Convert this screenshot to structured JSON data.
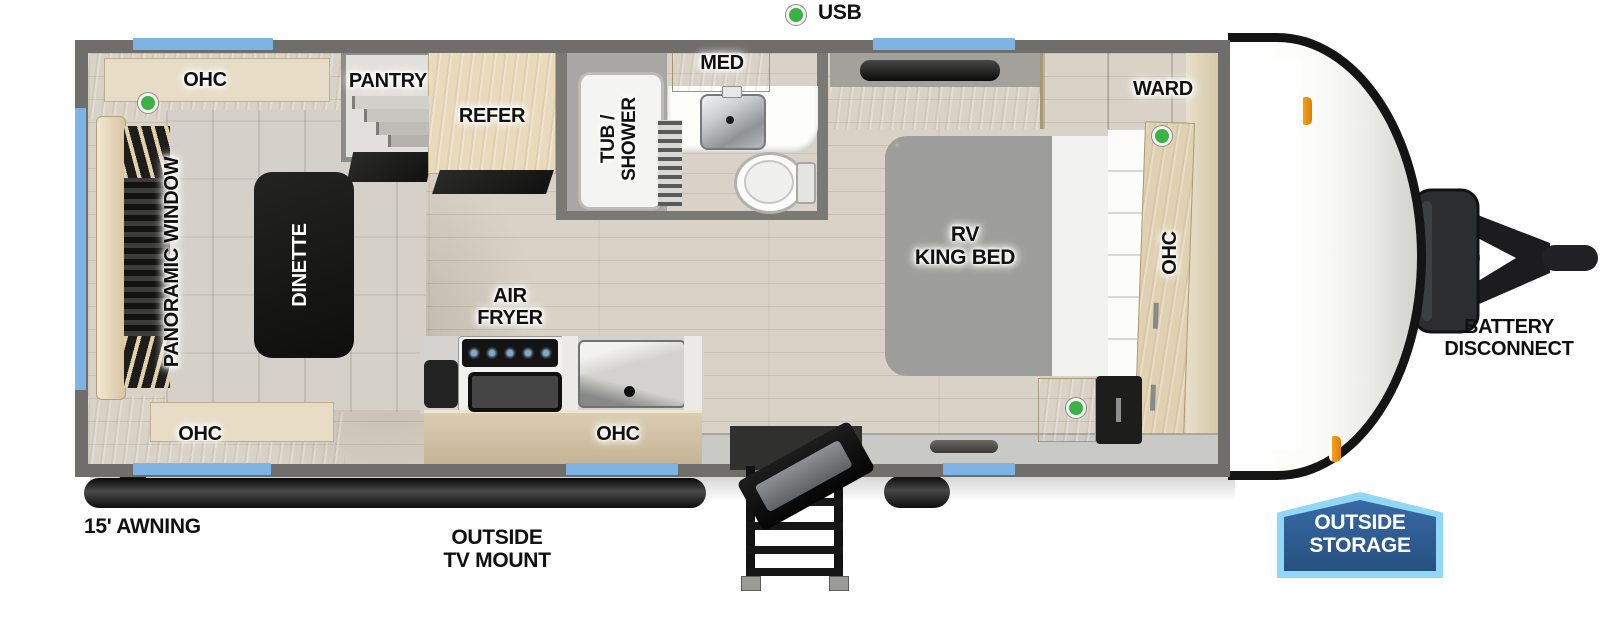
{
  "colors": {
    "window_blue": "#7db4e4",
    "wall_gray": "#6f6e6b",
    "indicator_green": "#3cb146",
    "badge_fill_top": "#33659f",
    "badge_fill_bottom": "#26507f",
    "badge_border": "#90d8f5",
    "floor_wood": "#d9d2c6"
  },
  "legend": {
    "usb": "USB"
  },
  "rear_lounge": {
    "ohc_top": "OHC",
    "ohc_bottom": "OHC",
    "panoramic_window": "PANORAMIC WINDOW",
    "dinette": "DINETTE",
    "pantry": "PANTRY"
  },
  "kitchen": {
    "refer": "REFER",
    "air_fryer": {
      "line1": "AIR",
      "line2": "FRYER"
    },
    "ohc": "OHC"
  },
  "bathroom": {
    "tub_shower": {
      "line1": "TUB /",
      "line2": "SHOWER"
    },
    "med": "MED"
  },
  "bedroom": {
    "ward": "WARD",
    "bed": {
      "line1": "RV",
      "line2": "KING BED"
    },
    "ohc": "OHC"
  },
  "exterior": {
    "awning": "15' AWNING",
    "tv_mount": {
      "line1": "OUTSIDE",
      "line2": "TV MOUNT"
    },
    "battery": {
      "line1": "BATTERY",
      "line2": "DISCONNECT"
    },
    "outside_storage": {
      "line1": "OUTSIDE",
      "line2": "STORAGE"
    }
  }
}
